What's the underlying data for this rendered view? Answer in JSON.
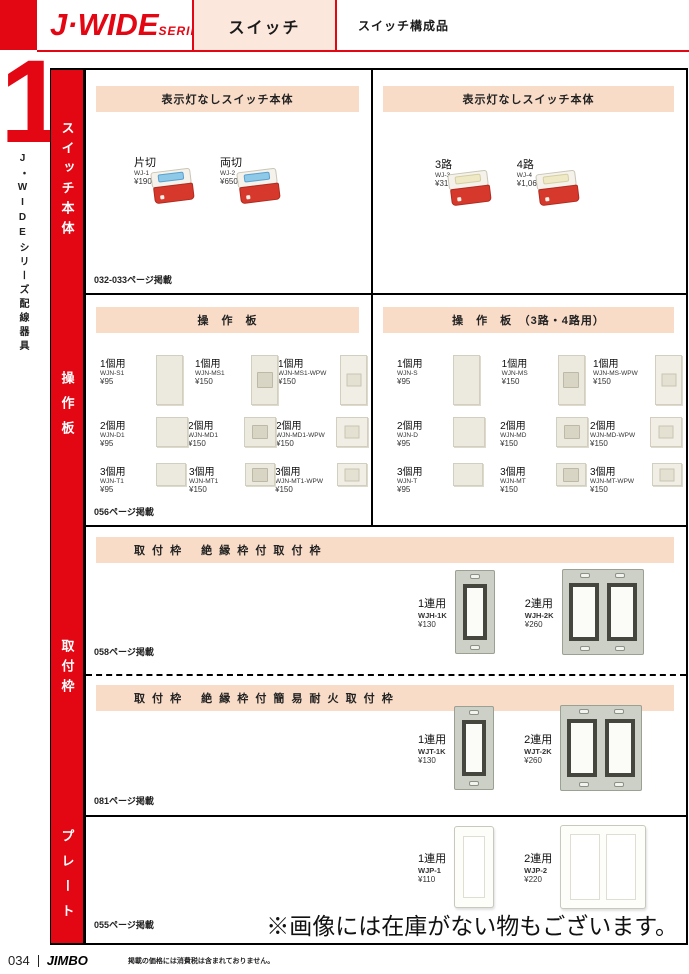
{
  "header": {
    "logo_main": "J·WIDE",
    "logo_sub": "SERIES",
    "tab_title": "スイッチ",
    "tab_subtitle": "スイッチ構成品",
    "section_number": "1",
    "side_vertical_text": "J・WIDEシリーズ配線器具",
    "accent_red": "#e30613",
    "banner_peach": "#f8dcc8"
  },
  "sidebar": {
    "labels": [
      "スイッチ本体",
      "操作板",
      "取付枠",
      "プレート"
    ]
  },
  "switch_body": {
    "left": {
      "banner": "表示灯なしスイッチ本体",
      "products": [
        {
          "name": "片切",
          "code": "WJ-1",
          "price": "¥190"
        },
        {
          "name": "両切",
          "code": "WJ-2",
          "price": "¥650"
        }
      ],
      "page_note": "032-033ページ掲載"
    },
    "right": {
      "banner": "表示灯なしスイッチ本体",
      "products": [
        {
          "name": "3路",
          "code": "WJ-3",
          "price": "¥310"
        },
        {
          "name": "4路",
          "code": "WJ-4",
          "price": "¥1,060"
        }
      ]
    }
  },
  "sousaban": {
    "left": {
      "banner": "操　作　板",
      "rows": [
        [
          {
            "name": "1個用",
            "code": "WJN-S1",
            "price": "¥95"
          },
          {
            "name": "1個用",
            "code": "WJN-MS1",
            "price": "¥150"
          },
          {
            "name": "1個用",
            "code": "WJN-MS1-WPW",
            "price": "¥150"
          }
        ],
        [
          {
            "name": "2個用",
            "code": "WJN-D1",
            "price": "¥95"
          },
          {
            "name": "2個用",
            "code": "WJN-MD1",
            "price": "¥150"
          },
          {
            "name": "2個用",
            "code": "WJN-MD1-WPW",
            "price": "¥150"
          }
        ],
        [
          {
            "name": "3個用",
            "code": "WJN-T1",
            "price": "¥95"
          },
          {
            "name": "3個用",
            "code": "WJN-MT1",
            "price": "¥150"
          },
          {
            "name": "3個用",
            "code": "WJN-MT1-WPW",
            "price": "¥150"
          }
        ]
      ],
      "page_note": "056ページ掲載"
    },
    "right": {
      "banner": "操　作　板　（3路・4路用）",
      "rows": [
        [
          {
            "name": "1個用",
            "code": "WJN-S",
            "price": "¥95"
          },
          {
            "name": "1個用",
            "code": "WJN-MS",
            "price": "¥150"
          },
          {
            "name": "1個用",
            "code": "WJN-MS-WPW",
            "price": "¥150"
          }
        ],
        [
          {
            "name": "2個用",
            "code": "WJN-D",
            "price": "¥95"
          },
          {
            "name": "2個用",
            "code": "WJN-MD",
            "price": "¥150"
          },
          {
            "name": "2個用",
            "code": "WJN-MD-WPW",
            "price": "¥150"
          }
        ],
        [
          {
            "name": "3個用",
            "code": "WJN-T",
            "price": "¥95"
          },
          {
            "name": "3個用",
            "code": "WJN-MT",
            "price": "¥150"
          },
          {
            "name": "3個用",
            "code": "WJN-MT-WPW",
            "price": "¥150"
          }
        ]
      ]
    }
  },
  "toritsukewaku": {
    "upper": {
      "banner": "取 付 枠　 絶 縁 枠 付 取 付 枠",
      "products": [
        {
          "name": "1連用",
          "code": "WJH-1K",
          "price": "¥130"
        },
        {
          "name": "2連用",
          "code": "WJH-2K",
          "price": "¥260"
        }
      ],
      "page_note": "058ページ掲載"
    },
    "lower": {
      "banner": "取 付 枠　 絶 縁 枠 付 簡 易 耐 火 取 付 枠",
      "products": [
        {
          "name": "1連用",
          "code": "WJT-1K",
          "price": "¥130"
        },
        {
          "name": "2連用",
          "code": "WJT-2K",
          "price": "¥260"
        }
      ],
      "page_note": "081ページ掲載"
    }
  },
  "plate": {
    "products": [
      {
        "name": "1連用",
        "code": "WJP-1",
        "price": "¥110"
      },
      {
        "name": "2連用",
        "code": "WJP-2",
        "price": "¥220"
      }
    ],
    "page_note": "055ページ掲載",
    "notice": "※画像には在庫がない物もございます。"
  },
  "footer": {
    "page_number": "034",
    "brand": "JIMBO",
    "note": "掲載の価格には消費税は含まれておりません。"
  }
}
